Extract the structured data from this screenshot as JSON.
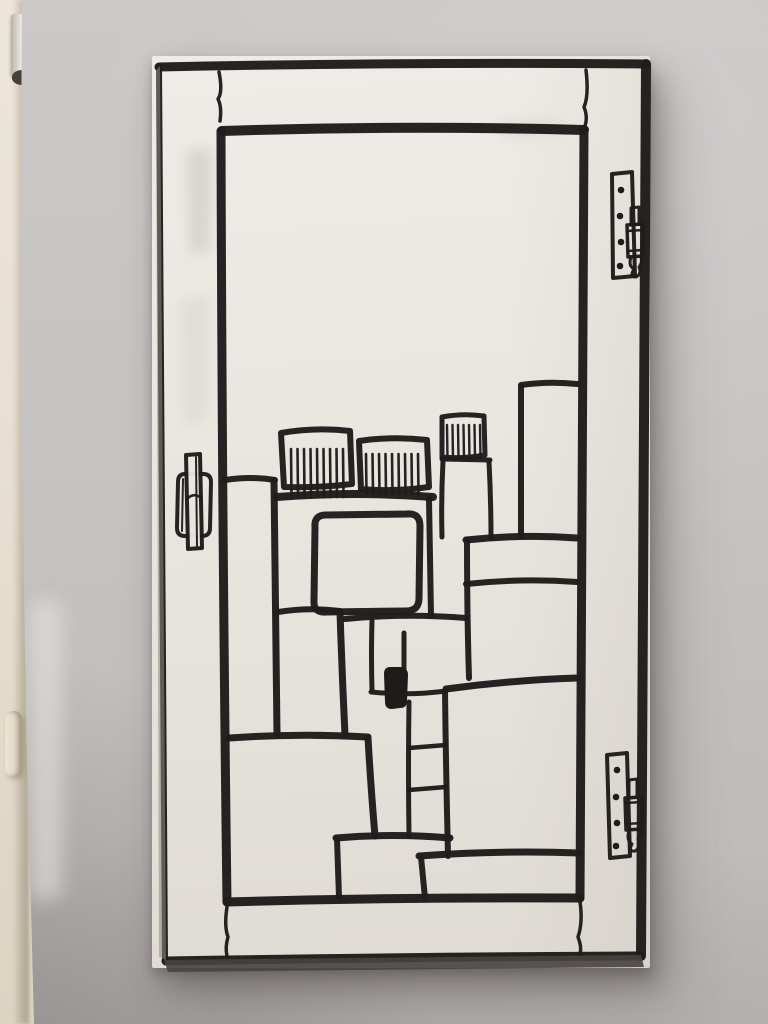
{
  "scene": {
    "wall_color_top": "#cbc8c7",
    "wall_color_bottom": "#bcb8b7",
    "wall_shadow_color": "#9d9896",
    "jamb_color": "#e7e0d2",
    "jamb_hinge_metal": "#d6d1c7",
    "jamb_hinge_cap": "#453f39",
    "jamb_latch_color": "#e4dcca"
  },
  "artwork": {
    "panel_color_top": "#eeebe6",
    "panel_color_bottom": "#dfdbd4",
    "panel_edge_dark": "#47423e",
    "ink": "#1e1d1c",
    "smudges": [
      {
        "n": "paint-smudge",
        "d": "M186,150 L212,148 L210,250 L190,255 Z",
        "c": "#b2ada6",
        "o": 0.35
      },
      {
        "n": "paint-smudge",
        "d": "M180,300 L210,295 L205,420 L185,425 Z",
        "c": "#c2bdb6",
        "o": 0.25
      },
      {
        "n": "paint-smudge",
        "d": "M500,120 L560,118 L558,136 L502,139 Z",
        "c": "#c7c2bb",
        "o": 0.3
      }
    ],
    "strokes": [
      {
        "n": "frame-top",
        "d": "M159,67 Q400,62 646,64",
        "w": 9
      },
      {
        "n": "frame-right",
        "d": "M646,64 Q643,500 641,956",
        "w": 10
      },
      {
        "n": "frame-bottom",
        "d": "M166,961 Q400,957 641,956",
        "w": 9
      },
      {
        "n": "frame-left",
        "d": "M159,67 Q161,500 165,960",
        "w": 6
      },
      {
        "n": "pane-top",
        "d": "M222,131 Q400,125 584,130",
        "w": 10
      },
      {
        "n": "pane-left",
        "d": "M221,131 Q222,520 227,902",
        "w": 9
      },
      {
        "n": "pane-right",
        "d": "M584,130 Q582,520 580,898",
        "w": 9
      },
      {
        "n": "pane-bottom",
        "d": "M227,902 Q400,897 580,898",
        "w": 9
      },
      {
        "n": "joint-crack-top-left",
        "d": "M219,72 Q223,92 218,99 Q222,107 220,121",
        "w": 3.5
      },
      {
        "n": "joint-crack-top-right",
        "d": "M586,70 Q589,96 584,107 Q588,117 585,126",
        "w": 3.5
      },
      {
        "n": "joint-crack-bottom-left",
        "d": "M227,907 Q224,926 228,937 Q225,947 227,956",
        "w": 3.5
      },
      {
        "n": "joint-crack-bottom-right",
        "d": "M580,902 Q583,922 578,937 Q582,947 580,954",
        "w": 3.5
      },
      {
        "n": "hinge-top-plate",
        "d": "M612,174 L632,172 L635,276 L613,278 Z",
        "w": 4
      },
      {
        "n": "hinge-top-pin",
        "d": "M631,208 L639,207 L639,224 L631,225 Z",
        "w": 3
      },
      {
        "n": "hinge-top-barrel",
        "d": "M627,225 L643,224 L643,256 L628,257 Z",
        "w": 3.5
      },
      {
        "n": "hinge-top-band",
        "d": "M627,231 L643,230",
        "w": 2.5
      },
      {
        "n": "hinge-top-band",
        "d": "M628,251 L643,250",
        "w": 2.5
      },
      {
        "n": "hinge-top-finial",
        "d": "M631,257 Q628,266 634,269 Q629,277 636,277 Q642,274 639,267 Q643,262 641,257",
        "w": 3
      },
      {
        "n": "hinge-bottom-plate",
        "d": "M607,755 L627,753 L630,856 L610,858 Z",
        "w": 4
      },
      {
        "n": "hinge-bottom-pin",
        "d": "M629,780 L637,779 L637,797 L629,798 Z",
        "w": 3
      },
      {
        "n": "hinge-bottom-barrel",
        "d": "M625,798 L642,797 L642,829 L626,830 Z",
        "w": 3.5
      },
      {
        "n": "hinge-bottom-band",
        "d": "M625,803 L642,802",
        "w": 2.5
      },
      {
        "n": "hinge-bottom-band",
        "d": "M626,824 L642,823",
        "w": 2.5
      },
      {
        "n": "hinge-bottom-finial",
        "d": "M629,830 Q626,841 632,844 Q628,852 635,851 Q641,848 638,839 Q642,834 640,830",
        "w": 3
      },
      {
        "n": "handle-plate",
        "d": "M185,474 L203,474 Q211,474 211,482 L210,528 Q210,536 202,536 L185,536 Q177,536 177,528 L178,482 Q178,474 185,474 Z",
        "w": 4
      },
      {
        "n": "handle-plate-inner-line",
        "d": "M183,479 L182,531",
        "w": 2
      },
      {
        "n": "handle-bar",
        "d": "M186,455 L200,454 L202,548 L188,549 Z",
        "w": 4,
        "f": "#e9e6e0"
      },
      {
        "n": "handle-bar-inner-line",
        "d": "M196,457 L197,546",
        "w": 2
      },
      {
        "n": "handle-bar-waist",
        "d": "M187,499 Q194,492 201,498",
        "w": 2.5
      },
      {
        "n": "comb-building-left",
        "d": "M281,433 Q316,427 350,431 L352,484 Q318,488 284,487 Z",
        "w": 6
      },
      {
        "n": "comb-building-middle",
        "d": "M359,441 Q393,436 427,440 L429,487 Q394,492 361,489 Z",
        "w": 6
      },
      {
        "n": "comb-building-right",
        "d": "M442,417 Q463,413 484,416 L485,455 Q463,459 442,457 Z",
        "w": 5
      },
      {
        "n": "tower-ledge",
        "d": "M442,459 L490,460",
        "w": 5
      },
      {
        "n": "tower-left-edge",
        "d": "M443,461 Q441,500 442,537",
        "w": 5
      },
      {
        "n": "tower-right-edge",
        "d": "M489,462 Q491,500 491,538",
        "w": 5
      },
      {
        "n": "roof-band",
        "d": "M277,497 Q355,491 433,497",
        "w": 8
      },
      {
        "n": "tall-right-building-top",
        "d": "M521,385 Q549,381 577,384",
        "w": 6
      },
      {
        "n": "tall-right-building-left",
        "d": "M521,386 L521,536",
        "w": 6
      },
      {
        "n": "left-building-top",
        "d": "M225,480 Q251,476 275,480",
        "w": 6
      },
      {
        "n": "left-building-right",
        "d": "M274,481 Q275,610 277,734",
        "w": 7
      },
      {
        "n": "center-building-right",
        "d": "M429,499 Q430,560 431,616",
        "w": 6
      },
      {
        "n": "window-rounded-rect",
        "d": "M326,515 L407,514 Q420,513 420,526 L419,598 Q419,611 406,611 L326,612 Q313,613 314,600 L315,527 Q314,515 326,515 Z",
        "w": 7
      },
      {
        "n": "middle-building-top",
        "d": "M278,612 Q309,607 340,611",
        "w": 6
      },
      {
        "n": "middle-building-right",
        "d": "M340,612 Q342,673 345,735",
        "w": 7
      },
      {
        "n": "cluster-top-line",
        "d": "M345,619 Q405,613 466,618",
        "w": 6
      },
      {
        "n": "cluster-divider",
        "d": "M372,621 Q371,655 372,690",
        "w": 5
      },
      {
        "n": "cluster-divider-short",
        "d": "M404,633 L404,669",
        "w": 5
      },
      {
        "n": "cluster-bottom-line",
        "d": "M371,692 Q408,696 446,691",
        "w": 5
      },
      {
        "n": "ladder-left-rail",
        "d": "M409,702 Q408,770 409,836",
        "w": 5
      },
      {
        "n": "ladder-right-rail",
        "d": "M445,691 Q446,775 448,856",
        "w": 6
      },
      {
        "n": "ladder-rung",
        "d": "M409,748 L446,745",
        "w": 4.5
      },
      {
        "n": "ladder-rung",
        "d": "M409,790 L446,787",
        "w": 4.5
      },
      {
        "n": "step-top-line",
        "d": "M336,838 Q393,833 450,838",
        "w": 7
      },
      {
        "n": "step-left-edge",
        "d": "M337,839 L339,897",
        "w": 6
      },
      {
        "n": "lower-step-top-line",
        "d": "M419,856 Q500,850 579,853",
        "w": 7
      },
      {
        "n": "lower-step-left-edge",
        "d": "M421,857 L425,898",
        "w": 6
      },
      {
        "n": "big-building-top",
        "d": "M229,738 Q299,733 368,737",
        "w": 7
      },
      {
        "n": "big-building-right",
        "d": "M368,738 Q371,790 375,836",
        "w": 7
      },
      {
        "n": "bottom-right-building-top",
        "d": "M446,689 Q512,680 578,678",
        "w": 7
      },
      {
        "n": "right-middle-building-top",
        "d": "M466,540 Q521,534 577,538",
        "w": 7
      },
      {
        "n": "right-middle-building-band",
        "d": "M466,584 Q521,578 577,582",
        "w": 6
      },
      {
        "n": "right-middle-building-left",
        "d": "M467,541 Q467,615 469,678",
        "w": 6
      }
    ],
    "hatches": [
      {
        "n": "comb-hatch-left",
        "xs": [
          291,
          297.5,
          304,
          310.5,
          317,
          323.5,
          330,
          336.5,
          343
        ],
        "y1": 449,
        "y2": 497,
        "w": 2.6
      },
      {
        "n": "comb-hatch-middle",
        "xs": [
          366,
          372.5,
          379,
          385.5,
          392,
          398.5,
          405,
          411.5,
          418
        ],
        "y1": 454,
        "y2": 494,
        "w": 2.6
      },
      {
        "n": "comb-hatch-right",
        "xs": [
          447,
          452.5,
          458,
          463.5,
          469,
          474.5,
          480
        ],
        "y1": 425,
        "y2": 459,
        "w": 2.4
      }
    ],
    "fills": [
      {
        "n": "black-block",
        "d": "M390,667 Q384,667 384,674 L385,702 Q385,709 392,709 L400,708 Q407,708 407,701 L408,675 Q408,668 401,667 Z",
        "c": "#1d1c1b",
        "o": 1
      },
      {
        "n": "panel-bottom-edge-face",
        "d": "M164,960 L641,955 L644,967 L168,972 Z",
        "c": "#47423e",
        "o": 0.9
      },
      {
        "n": "panel-left-edge-face",
        "d": "M156,70 L160,66 L166,960 L159,957 Z",
        "c": "#8f8a84",
        "o": 0.55
      }
    ],
    "dots": [
      {
        "n": "hinge-screw",
        "cx": 621,
        "cy": 190,
        "r": 3.3
      },
      {
        "n": "hinge-screw",
        "cx": 620,
        "cy": 216,
        "r": 3.3
      },
      {
        "n": "hinge-screw",
        "cx": 621,
        "cy": 242,
        "r": 3.3
      },
      {
        "n": "hinge-screw",
        "cx": 620,
        "cy": 266,
        "r": 3.3
      },
      {
        "n": "hinge-screw",
        "cx": 617,
        "cy": 770,
        "r": 3.3
      },
      {
        "n": "hinge-screw",
        "cx": 616,
        "cy": 797,
        "r": 3.3
      },
      {
        "n": "hinge-screw",
        "cx": 617,
        "cy": 823,
        "r": 3.3
      },
      {
        "n": "hinge-screw",
        "cx": 616,
        "cy": 846,
        "r": 3.3
      }
    ]
  }
}
